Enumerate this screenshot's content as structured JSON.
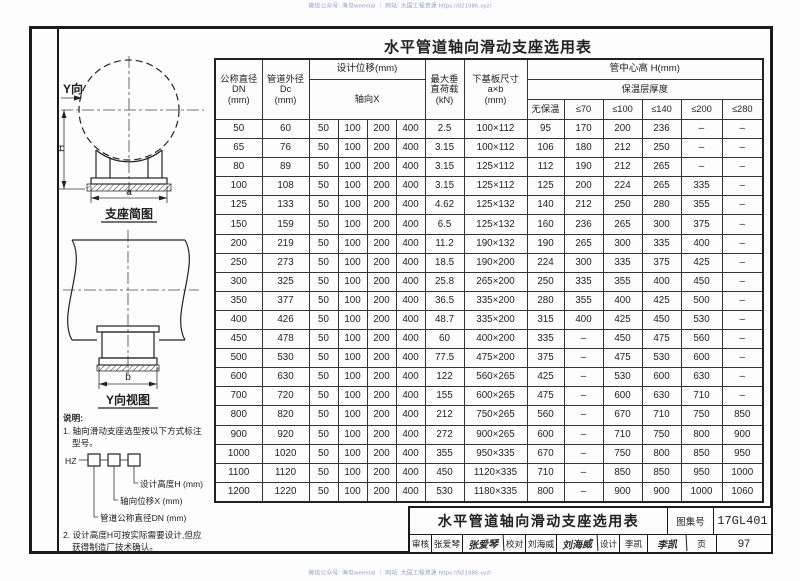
{
  "watermark": {
    "top": "微信公众号: 海见weental ｜ 网站: 大国工程资源 https://521986.xyz/",
    "bottom": "微信公众号: 海见weental ｜ 网站: 大国工程资源 https://521986.xyz/"
  },
  "diagrams": {
    "y_direction": "Y向",
    "sketch1_label": "支座简图",
    "dim_h": "H",
    "dim_a": "a",
    "sketch2_label": "Y向视图",
    "dim_b": "b"
  },
  "notes": {
    "heading": "说明:",
    "note1_line1": "1. 轴向滑动支座选型按以下方式标注",
    "note1_line2": "型号。",
    "model_prefix": "HZ",
    "leader_height": "设计高度H (mm)",
    "leader_disp": "轴向位移X (mm)",
    "leader_dn": "管道公称直径DN (mm)",
    "note2_line1": "2. 设计高度H可按实际需要设计,但应",
    "note2_line2": "获得制造厂技术确认。"
  },
  "table": {
    "title": "水平管道轴向滑动支座选用表",
    "header": {
      "col_dn": [
        "公称直径",
        "DN",
        "(mm)"
      ],
      "col_dc": [
        "管道外径",
        "Dc",
        "(mm)"
      ],
      "disp_group": "设计位移(mm)",
      "disp_sub": "轴向X",
      "col_load": [
        "最大垂",
        "直荷载",
        "(kN)"
      ],
      "col_plate": [
        "下基板尺寸",
        "a×b",
        "(mm)"
      ],
      "height_group": "管中心高 H(mm)",
      "height_sub": "保温层厚度",
      "height_cols": [
        "无保温",
        "≤70",
        "≤100",
        "≤140",
        "≤200",
        "≤280"
      ]
    },
    "rows": [
      [
        "50",
        "60",
        "50",
        "100",
        "200",
        "400",
        "2.5",
        "100×112",
        "95",
        "170",
        "200",
        "236",
        "–",
        "–"
      ],
      [
        "65",
        "76",
        "50",
        "100",
        "200",
        "400",
        "3.15",
        "100×112",
        "106",
        "180",
        "212",
        "250",
        "–",
        "–"
      ],
      [
        "80",
        "89",
        "50",
        "100",
        "200",
        "400",
        "3.15",
        "125×112",
        "112",
        "190",
        "212",
        "265",
        "–",
        "–"
      ],
      [
        "100",
        "108",
        "50",
        "100",
        "200",
        "400",
        "3.15",
        "125×112",
        "125",
        "200",
        "224",
        "265",
        "335",
        "–"
      ],
      [
        "125",
        "133",
        "50",
        "100",
        "200",
        "400",
        "4.62",
        "125×132",
        "140",
        "212",
        "250",
        "280",
        "355",
        "–"
      ],
      [
        "150",
        "159",
        "50",
        "100",
        "200",
        "400",
        "6.5",
        "125×132",
        "160",
        "236",
        "265",
        "300",
        "375",
        "–"
      ],
      [
        "200",
        "219",
        "50",
        "100",
        "200",
        "400",
        "11.2",
        "190×132",
        "190",
        "265",
        "300",
        "335",
        "400",
        "–"
      ],
      [
        "250",
        "273",
        "50",
        "100",
        "200",
        "400",
        "18.5",
        "190×200",
        "224",
        "300",
        "335",
        "375",
        "425",
        "–"
      ],
      [
        "300",
        "325",
        "50",
        "100",
        "200",
        "400",
        "25.8",
        "265×200",
        "250",
        "335",
        "355",
        "400",
        "450",
        "–"
      ],
      [
        "350",
        "377",
        "50",
        "100",
        "200",
        "400",
        "36.5",
        "335×200",
        "280",
        "355",
        "400",
        "425",
        "500",
        "–"
      ],
      [
        "400",
        "426",
        "50",
        "100",
        "200",
        "400",
        "48.7",
        "335×200",
        "315",
        "400",
        "425",
        "450",
        "530",
        "–"
      ],
      [
        "450",
        "478",
        "50",
        "100",
        "200",
        "400",
        "60",
        "400×200",
        "335",
        "–",
        "450",
        "475",
        "560",
        "–"
      ],
      [
        "500",
        "530",
        "50",
        "100",
        "200",
        "400",
        "77.5",
        "475×200",
        "375",
        "–",
        "475",
        "530",
        "600",
        "–"
      ],
      [
        "600",
        "630",
        "50",
        "100",
        "200",
        "400",
        "122",
        "560×265",
        "425",
        "–",
        "530",
        "600",
        "630",
        "–"
      ],
      [
        "700",
        "720",
        "50",
        "100",
        "200",
        "400",
        "155",
        "600×265",
        "475",
        "–",
        "600",
        "630",
        "710",
        "–"
      ],
      [
        "800",
        "820",
        "50",
        "100",
        "200",
        "400",
        "212",
        "750×265",
        "560",
        "–",
        "670",
        "710",
        "750",
        "850"
      ],
      [
        "900",
        "920",
        "50",
        "100",
        "200",
        "400",
        "272",
        "900×265",
        "600",
        "–",
        "710",
        "750",
        "800",
        "900"
      ],
      [
        "1000",
        "1020",
        "50",
        "100",
        "200",
        "400",
        "355",
        "950×335",
        "670",
        "–",
        "750",
        "800",
        "850",
        "950"
      ],
      [
        "1100",
        "1120",
        "50",
        "100",
        "200",
        "400",
        "450",
        "1120×335",
        "710",
        "–",
        "850",
        "850",
        "950",
        "1000"
      ],
      [
        "1200",
        "1220",
        "50",
        "100",
        "200",
        "400",
        "530",
        "1180×335",
        "800",
        "–",
        "900",
        "900",
        "1000",
        "1060"
      ]
    ]
  },
  "title_block": {
    "title": "水平管道轴向滑动支座选用表",
    "atlas_label": "图集号",
    "atlas_no": "17GL401",
    "page_label": "页",
    "page_no": "97",
    "staff": [
      {
        "label": "审核",
        "name": "张爱琴",
        "sig": "张爱琴"
      },
      {
        "label": "校对",
        "name": "刘海威",
        "sig": "刘海威"
      },
      {
        "label": "设计",
        "name": "李凯",
        "sig": "李凯"
      }
    ]
  }
}
